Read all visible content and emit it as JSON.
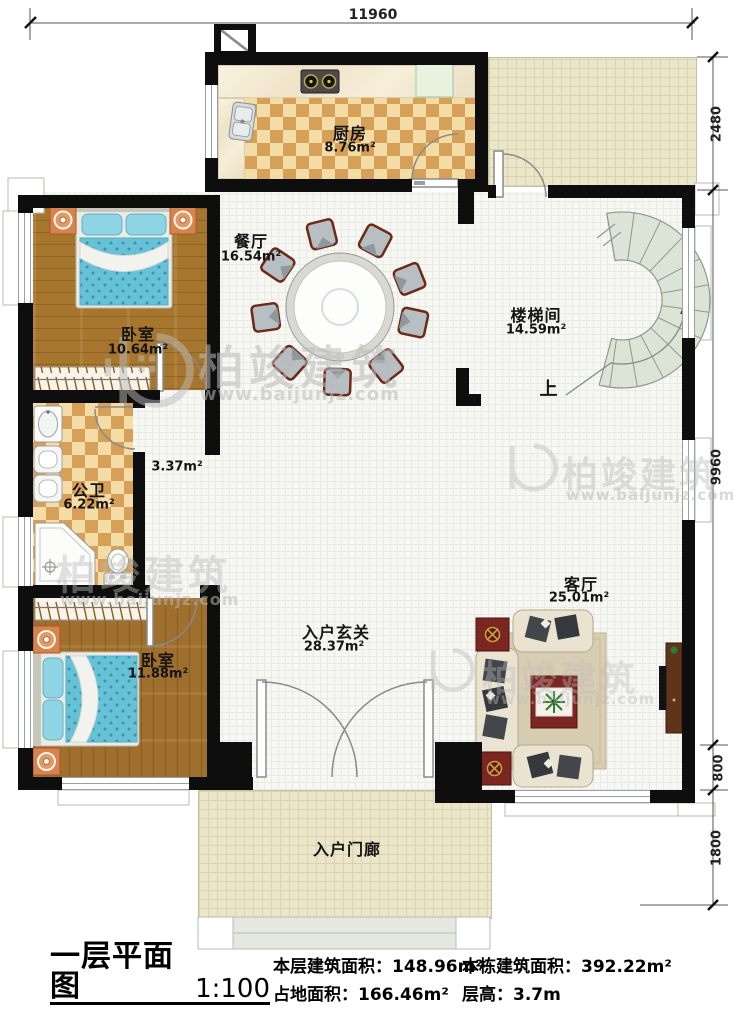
{
  "title_block": {
    "plan_name": "一层平面图",
    "scale": "1:100",
    "stats": [
      {
        "label": "本层建筑面积：",
        "value": "148.96m²"
      },
      {
        "label": "占地面积：",
        "value": "166.46m²"
      },
      {
        "label": "本栋建筑面积：",
        "value": "392.22m²"
      },
      {
        "label": "层高：",
        "value": "3.7m"
      }
    ]
  },
  "dimensions": {
    "top": "11960",
    "right": [
      "2480",
      "9960",
      "800",
      "1800"
    ]
  },
  "rooms": {
    "kitchen": {
      "name": "厨房",
      "area": "8.76m²"
    },
    "dining": {
      "name": "餐厅",
      "area": "16.54m²"
    },
    "bedroom1": {
      "name": "卧室",
      "area": "10.64m²"
    },
    "stairwell": {
      "name": "楼梯间",
      "area": "14.59m²"
    },
    "bathroom": {
      "name": "公卫",
      "area": "6.22m²"
    },
    "hallway": {
      "area": "3.37m²"
    },
    "bedroom2": {
      "name": "卧室",
      "area": "11.88m²"
    },
    "foyer": {
      "name": "入户玄关",
      "area": "28.37m²"
    },
    "living": {
      "name": "客厅",
      "area": "25.01m²"
    },
    "porch": {
      "name": "入户门廊"
    }
  },
  "annotations": {
    "stairs_up": "上"
  },
  "watermark": {
    "brand": "柏竣建筑",
    "site": "www.baijunjz.com"
  },
  "colors": {
    "wall": "#0e0e0e",
    "wood": "#a6762f",
    "checker": "#d7a058",
    "bed": "#6ac3d8",
    "stair": "#dce3d7",
    "accent_red": "#7c2622"
  }
}
